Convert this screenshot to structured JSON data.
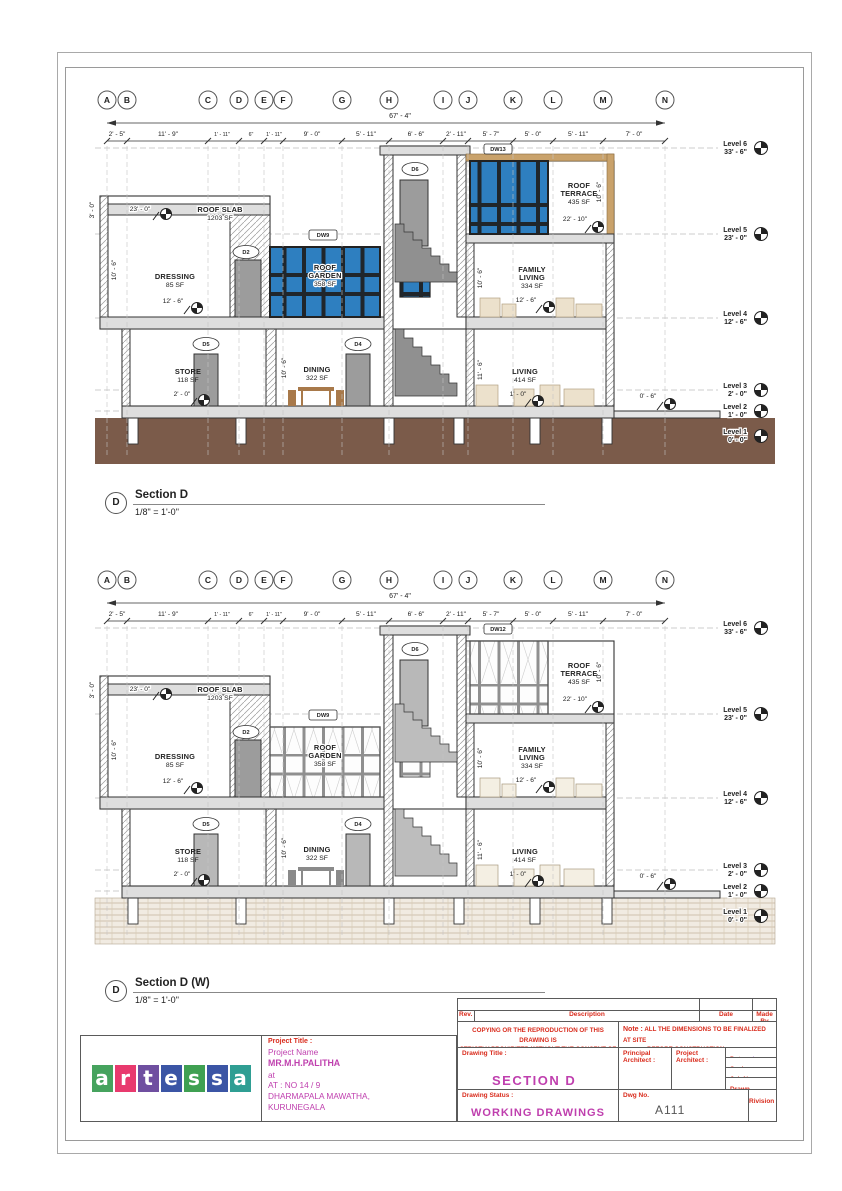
{
  "grid": {
    "labels": [
      "A",
      "B",
      "C",
      "D",
      "E",
      "F",
      "G",
      "H",
      "I",
      "J",
      "K",
      "L",
      "M",
      "N"
    ],
    "overall": "67' - 4\"",
    "dims": [
      "2' - 5\"",
      "11' - 9\"",
      "1' - 11\"",
      "6\"",
      "1' - 11\"",
      "9' - 0\"",
      "5' - 11\"",
      "6' - 6\"",
      "2' - 11\"",
      "5' - 7\"",
      "5' - 0\"",
      "5' - 11\"",
      "7' - 0\""
    ]
  },
  "levels": [
    {
      "name": "Level 6",
      "elev": "33' - 6\""
    },
    {
      "name": "Level 5",
      "elev": "23' - 0\""
    },
    {
      "name": "Level 4",
      "elev": "12' - 6\""
    },
    {
      "name": "Level 3",
      "elev": "2' - 0\""
    },
    {
      "name": "Level 2",
      "elev": "1' - 0\""
    },
    {
      "name": "Level 1",
      "elev": "0' - 0\""
    }
  ],
  "rooms": {
    "roof_slab": {
      "name": "ROOF SLAB",
      "area": "1203 SF",
      "elev": "23' - 0\""
    },
    "dressing": {
      "name": "DRESSING",
      "area": "85 SF",
      "elev": "12' - 6\""
    },
    "store": {
      "name": "STORE",
      "area": "118 SF",
      "elev": "2' - 0\""
    },
    "roof_garden": {
      "l1": "ROOF",
      "l2": "GARDEN",
      "area": "358 SF"
    },
    "dining": {
      "name": "DINING",
      "area": "322 SF"
    },
    "roof_terrace": {
      "l1": "ROOF",
      "l2": "TERRACE",
      "area": "435 SF",
      "elev": "22' - 10\""
    },
    "family_living": {
      "l1": "FAMILY",
      "l2": "LIVING",
      "area": "334 SF",
      "elev": "12' - 6\""
    },
    "living": {
      "name": "LIVING",
      "area": "414 SF",
      "elev": "1' - 0\""
    },
    "exterior": {
      "elev": "0' - 6\""
    }
  },
  "vdims": {
    "v30": "3' - 0\"",
    "v106": "10' - 6\"",
    "v116": "11' - 6\""
  },
  "tags": {
    "d2": "D2",
    "d4": "D4",
    "d5": "D5",
    "d6": "D6",
    "dw9": "DW9"
  },
  "sections": [
    {
      "bubble": "D",
      "title": "Section D",
      "scale": "1/8\" = 1'-0\"",
      "window_tag": "DW13"
    },
    {
      "bubble": "D",
      "title": "Section D (W)",
      "scale": "1/8\" = 1'-0\"",
      "window_tag": "DW12"
    }
  ],
  "titleblock": {
    "rev": "Rev.",
    "description": "Description",
    "date": "Date",
    "made_by": "Made By",
    "copy_line1": "COPYING OR THE REPRODUCTION OF THIS DRAWING IS",
    "copy_line2": "STRICTLY PROHIBITED WITHOUT THE CONSENT OF",
    "note_label": "Note :",
    "note_line1": "ALL THE DIMENSIONS TO BE FINALIZED AT SITE",
    "note_line2": "BEFORE CONSTRUCTION",
    "drawing_title_label": "Drawing Title :",
    "drawing_title": "SECTION D",
    "principal_architect_label": "Principal Architect :",
    "project_architect_label": "Project Architect :",
    "date_label": "Date :",
    "date_value": "Issue Date",
    "scale_label": "Scale :",
    "scale_value": "1\"=8'@A3",
    "job_label": "Job No :",
    "drawn_label": "Drawn :",
    "drawn_value": "L.L.Chamath",
    "status_label": "Drawing Status :",
    "status_value": "WORKING DRAWINGS",
    "dwg_label": "Dwg No.",
    "dwg_value": "A111",
    "revision_label": "Rivision",
    "project_title_label": "Project Title :",
    "project_name_label": "Project Name",
    "client": "MR.M.H.PALITHA",
    "at": "at",
    "address1": "AT : NO 14 / 9",
    "address2": "DHARMAPALA MAWATHA,",
    "address3": "KURUNEGALA"
  },
  "logo": {
    "name": "artessa",
    "letters": [
      "a",
      "r",
      "t",
      "e",
      "s",
      "s",
      "a"
    ],
    "colors": [
      "#46a35e",
      "#e83a6e",
      "#6f4fa0",
      "#3b55a5",
      "#3fa052",
      "#3b55a5",
      "#2f9e93"
    ]
  },
  "colors": {
    "glass": "#2e7fc0",
    "ground": "#7b5b4a",
    "wood": "#c9a26b",
    "label_red": "#d92b1c",
    "value_magenta": "#bf3fae"
  }
}
